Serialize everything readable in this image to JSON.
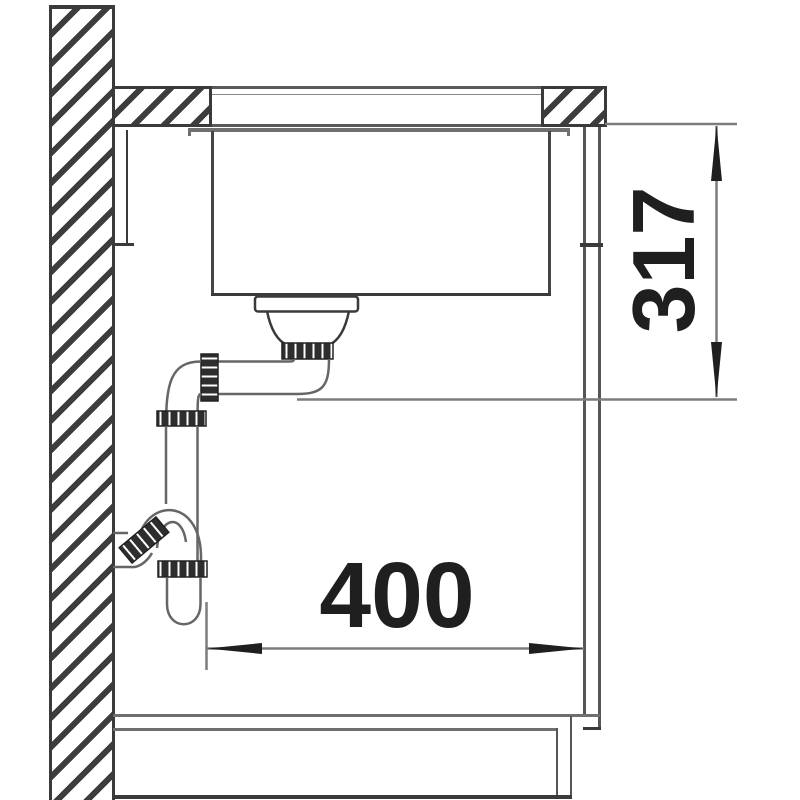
{
  "diagram": {
    "kind": "sink installation cross-section drawing",
    "dimensions": {
      "height": {
        "value": "317",
        "orientation": "vertical"
      },
      "width": {
        "value": "400",
        "orientation": "horizontal"
      }
    },
    "colors": {
      "background": "#ffffff",
      "outline_dark": "#3a3a3a",
      "outline_gray": "#6f6f6f",
      "dimension_line": "#7d7d7d",
      "dimension_text": "#1f1f1f",
      "fitting_nut": "#2e2e2e"
    }
  }
}
